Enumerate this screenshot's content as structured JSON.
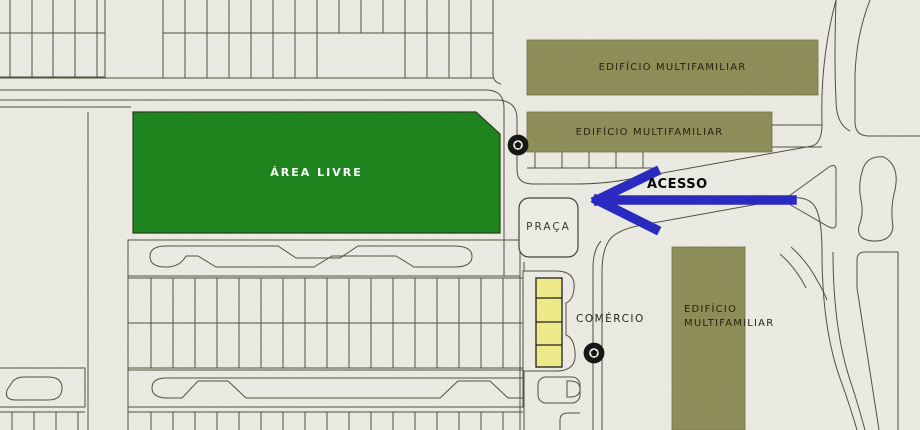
{
  "map": {
    "region_labels": {
      "area_livre": "ÁREA LIVRE",
      "praca": "PRAÇA",
      "comercio": "COMÉRCIO",
      "acesso": "ACESSO"
    },
    "buildings": [
      {
        "label": "EDIFÍCIO MULTIFAMILIAR"
      },
      {
        "label": "EDIFÍCIO MULTIFAMILIAR"
      },
      {
        "label": "EDIFÍCIO MULTIFAMILIAR"
      }
    ],
    "icons": {
      "marker_upper": "ring-stop-marker-icon",
      "marker_lower": "ring-stop-marker-icon",
      "arrow": "access-left-arrow"
    },
    "colors": {
      "background": "#f1f1ea",
      "linework": "#4c4b37",
      "green_area": "#158315",
      "building_olive": "#8d8d55",
      "commerce_yellow": "#f5f18a",
      "access_blue": "#2121c6",
      "marker_black": "#0d0d0d",
      "label_dark": "#26250f"
    }
  }
}
